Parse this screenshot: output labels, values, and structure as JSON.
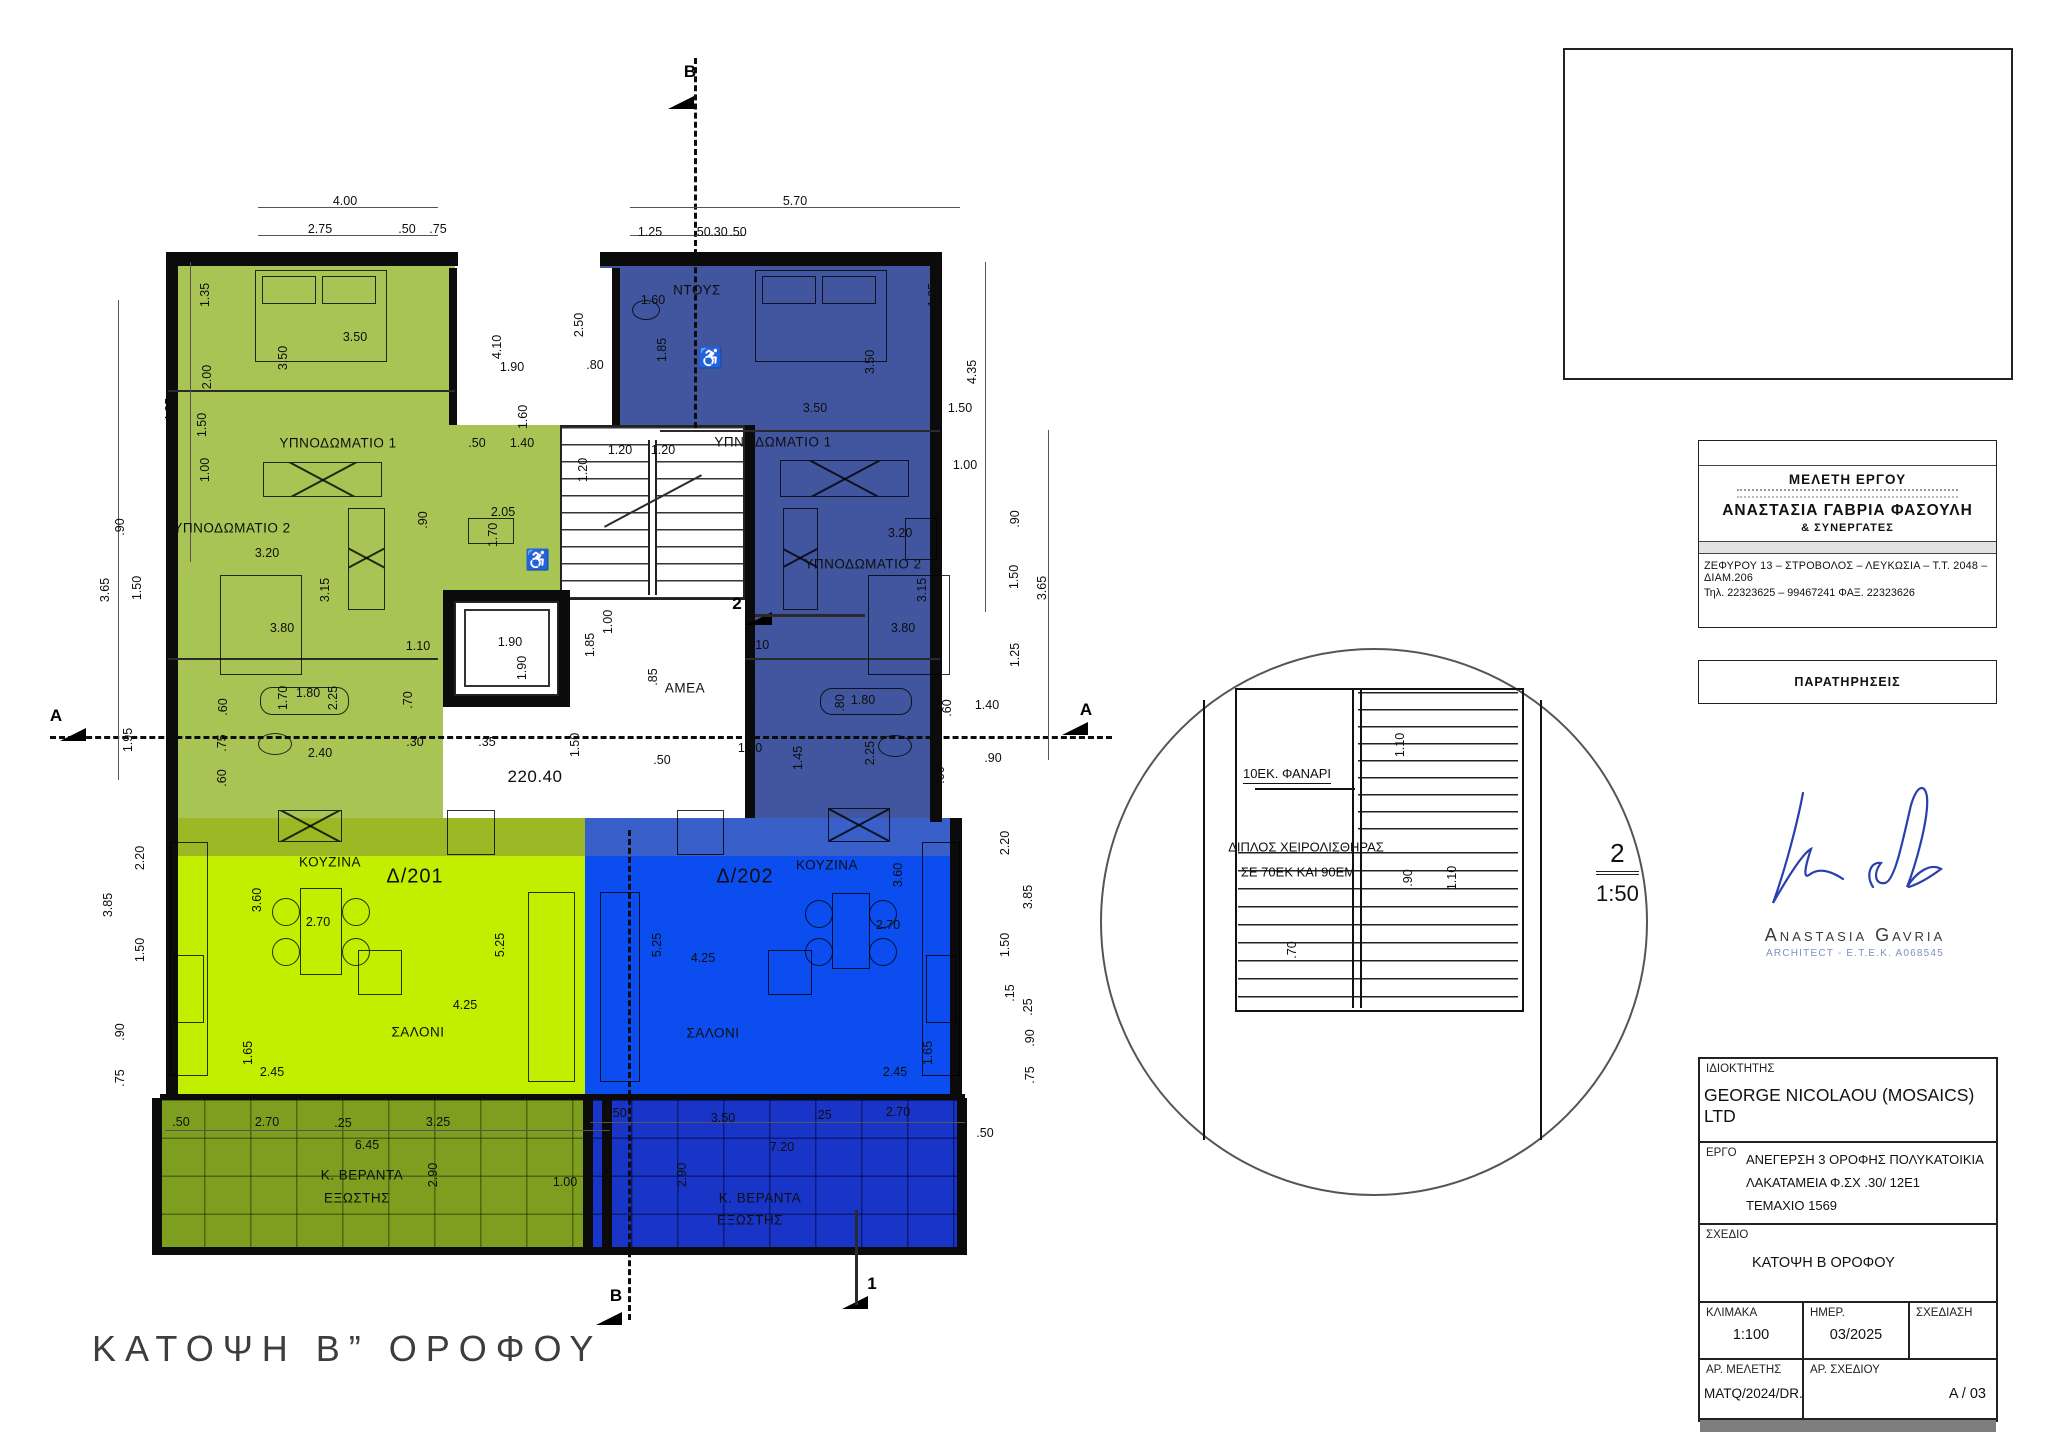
{
  "drawing_title": "ΚΑΤΟΨΗ Β” ΟΡΟΦΟΥ",
  "colors": {
    "green_bed": "#a8c455",
    "green_living": "#c2ee00",
    "green_veranda": "#7d9e1f",
    "blue_bed": "#41569f",
    "blue_living": "#0c4df0",
    "blue_veranda": "#1935c8",
    "signature_ink": "#2a3fae"
  },
  "plan": {
    "rooms": [
      {
        "t": "ΥΠΝΟΔΩΜΑΤΙΟ 1",
        "x": 338,
        "y": 443
      },
      {
        "t": "ΥΠΝΟΔΩΜΑΤΙΟ 2",
        "x": 232,
        "y": 528
      },
      {
        "t": "ΚΟΥΖΙΝΑ",
        "x": 330,
        "y": 862
      },
      {
        "t": "Δ/201",
        "x": 415,
        "y": 877,
        "c": "unit"
      },
      {
        "t": "ΣΑΛΟΝΙ",
        "x": 418,
        "y": 1032
      },
      {
        "t": "Κ. ΒΕΡΑΝΤΑ",
        "x": 362,
        "y": 1175
      },
      {
        "t": "ΕΞΩΣΤΗΣ",
        "x": 357,
        "y": 1198
      },
      {
        "t": "ΝΤΟΥΣ",
        "x": 697,
        "y": 290
      },
      {
        "t": "ΥΠΝΟΔΩΜΑΤΙΟ 1",
        "x": 773,
        "y": 442
      },
      {
        "t": "ΥΠΝΟΔΩΜΑΤΙΟ 2",
        "x": 863,
        "y": 564
      },
      {
        "t": "ΚΟΥΖΙΝΑ",
        "x": 827,
        "y": 865
      },
      {
        "t": "Δ/202",
        "x": 745,
        "y": 877,
        "c": "unit"
      },
      {
        "t": "ΣΑΛΟΝΙ",
        "x": 713,
        "y": 1033
      },
      {
        "t": "Κ. ΒΕΡΑΝΤΑ",
        "x": 760,
        "y": 1198
      },
      {
        "t": "ΕΞΩΣΤΗΣ",
        "x": 750,
        "y": 1220
      },
      {
        "t": "ΑΜΕΑ",
        "x": 685,
        "y": 688
      },
      {
        "t": "220.40",
        "x": 535,
        "y": 777,
        "c": "level"
      },
      {
        "t": "♿",
        "x": 538,
        "y": 560,
        "c": "unit"
      },
      {
        "t": "♿",
        "x": 711,
        "y": 358,
        "c": "unit"
      }
    ],
    "dims": [
      {
        "t": "4.00",
        "x": 345,
        "y": 201
      },
      {
        "t": "2.75",
        "x": 320,
        "y": 229
      },
      {
        "t": ".50",
        "x": 407,
        "y": 229
      },
      {
        "t": ".75",
        "x": 438,
        "y": 229
      },
      {
        "t": "5.70",
        "x": 795,
        "y": 201
      },
      {
        "t": "1.25",
        "x": 650,
        "y": 232
      },
      {
        "t": ".50",
        "x": 702,
        "y": 232
      },
      {
        "t": ".30",
        "x": 719,
        "y": 232
      },
      {
        "t": ".50",
        "x": 738,
        "y": 232
      },
      {
        "t": "1.35",
        "x": 205,
        "y": 295,
        "r": 1
      },
      {
        "t": "2.00",
        "x": 207,
        "y": 377,
        "r": 1
      },
      {
        "t": "1.50",
        "x": 202,
        "y": 425,
        "r": 1
      },
      {
        "t": "1.00",
        "x": 205,
        "y": 470,
        "r": 1
      },
      {
        "t": "4.35",
        "x": 170,
        "y": 410,
        "r": 1
      },
      {
        "t": ".90",
        "x": 120,
        "y": 527,
        "r": 1
      },
      {
        "t": "3.65",
        "x": 105,
        "y": 590,
        "r": 1
      },
      {
        "t": "1.50",
        "x": 137,
        "y": 588,
        "r": 1
      },
      {
        "t": "1.95",
        "x": 128,
        "y": 740,
        "r": 1
      },
      {
        "t": "2.20",
        "x": 140,
        "y": 858,
        "r": 1
      },
      {
        "t": "3.85",
        "x": 108,
        "y": 905,
        "r": 1
      },
      {
        "t": "1.50",
        "x": 140,
        "y": 950,
        "r": 1
      },
      {
        "t": ".90",
        "x": 120,
        "y": 1032,
        "r": 1
      },
      {
        "t": ".75",
        "x": 120,
        "y": 1078,
        "r": 1
      },
      {
        "t": "3.50",
        "x": 355,
        "y": 337
      },
      {
        "t": "3.50",
        "x": 283,
        "y": 358,
        "r": 1
      },
      {
        "t": "4.10",
        "x": 497,
        "y": 347,
        "r": 1
      },
      {
        "t": "1.90",
        "x": 512,
        "y": 367
      },
      {
        "t": "1.60",
        "x": 523,
        "y": 417,
        "r": 1
      },
      {
        "t": ".50",
        "x": 477,
        "y": 443
      },
      {
        "t": "1.40",
        "x": 522,
        "y": 443
      },
      {
        "t": "3.20",
        "x": 267,
        "y": 553
      },
      {
        "t": "3.15",
        "x": 325,
        "y": 590,
        "r": 1
      },
      {
        "t": "3.80",
        "x": 282,
        "y": 628
      },
      {
        "t": "1.10",
        "x": 418,
        "y": 646
      },
      {
        "t": "2.05",
        "x": 503,
        "y": 512
      },
      {
        "t": "1.70",
        "x": 493,
        "y": 535,
        "r": 1
      },
      {
        "t": ".90",
        "x": 423,
        "y": 520,
        "r": 1
      },
      {
        "t": "1.80",
        "x": 308,
        "y": 693
      },
      {
        "t": "2.25",
        "x": 333,
        "y": 698,
        "r": 1
      },
      {
        "t": "1.70",
        "x": 283,
        "y": 698,
        "r": 1
      },
      {
        "t": ".70",
        "x": 408,
        "y": 700,
        "r": 1
      },
      {
        "t": "2.40",
        "x": 320,
        "y": 753
      },
      {
        "t": ".30",
        "x": 415,
        "y": 742
      },
      {
        "t": ".60",
        "x": 223,
        "y": 707,
        "r": 1
      },
      {
        "t": ".75",
        "x": 222,
        "y": 743,
        "r": 1
      },
      {
        "t": ".60",
        "x": 222,
        "y": 778,
        "r": 1
      },
      {
        "t": ".90",
        "x": 173,
        "y": 703,
        "r": 1
      },
      {
        "t": "1.20",
        "x": 583,
        "y": 470,
        "r": 1
      },
      {
        "t": "1.20",
        "x": 620,
        "y": 450
      },
      {
        "t": "1.20",
        "x": 663,
        "y": 450
      },
      {
        "t": "1.00",
        "x": 608,
        "y": 622,
        "r": 1
      },
      {
        "t": "1.85",
        "x": 590,
        "y": 645,
        "r": 1
      },
      {
        "t": ".85",
        "x": 653,
        "y": 677,
        "r": 1
      },
      {
        "t": "1.90",
        "x": 510,
        "y": 642
      },
      {
        "t": "1.90",
        "x": 522,
        "y": 668,
        "r": 1
      },
      {
        "t": ".35",
        "x": 487,
        "y": 742
      },
      {
        "t": "1.50",
        "x": 575,
        "y": 745,
        "r": 1
      },
      {
        "t": ".50",
        "x": 662,
        "y": 760
      },
      {
        "t": ".70",
        "x": 750,
        "y": 697,
        "r": 1
      },
      {
        "t": "1.10",
        "x": 750,
        "y": 748
      },
      {
        "t": "1.60",
        "x": 653,
        "y": 300
      },
      {
        "t": "2.50",
        "x": 579,
        "y": 325,
        "r": 1
      },
      {
        "t": ".80",
        "x": 595,
        "y": 365
      },
      {
        "t": "1.85",
        "x": 662,
        "y": 350,
        "r": 1
      },
      {
        "t": "3.50",
        "x": 815,
        "y": 408
      },
      {
        "t": "3.50",
        "x": 870,
        "y": 362,
        "r": 1
      },
      {
        "t": "1.35",
        "x": 933,
        "y": 295,
        "r": 1
      },
      {
        "t": "2.00",
        "x": 935,
        "y": 390,
        "r": 1
      },
      {
        "t": "1.50",
        "x": 960,
        "y": 408
      },
      {
        "t": "1.00",
        "x": 965,
        "y": 465
      },
      {
        "t": "4.35",
        "x": 972,
        "y": 372,
        "r": 1
      },
      {
        "t": "3.20",
        "x": 900,
        "y": 533
      },
      {
        "t": "3.15",
        "x": 922,
        "y": 590,
        "r": 1
      },
      {
        "t": "3.80",
        "x": 903,
        "y": 628
      },
      {
        "t": "1.10",
        "x": 757,
        "y": 645
      },
      {
        "t": ".90",
        "x": 1015,
        "y": 519,
        "r": 1
      },
      {
        "t": "1.50",
        "x": 1014,
        "y": 577,
        "r": 1
      },
      {
        "t": "3.65",
        "x": 1042,
        "y": 588,
        "r": 1
      },
      {
        "t": "1.25",
        "x": 1015,
        "y": 655,
        "r": 1
      },
      {
        "t": "1.80",
        "x": 863,
        "y": 700
      },
      {
        "t": ".80",
        "x": 840,
        "y": 703,
        "r": 1
      },
      {
        "t": "2.25",
        "x": 870,
        "y": 753,
        "r": 1
      },
      {
        "t": "1.45",
        "x": 798,
        "y": 758,
        "r": 1
      },
      {
        "t": ".60",
        "x": 947,
        "y": 708,
        "r": 1
      },
      {
        "t": "1.40",
        "x": 987,
        "y": 705
      },
      {
        "t": ".75",
        "x": 938,
        "y": 743,
        "r": 1
      },
      {
        "t": ".90",
        "x": 993,
        "y": 758
      },
      {
        "t": ".60",
        "x": 940,
        "y": 775,
        "r": 1
      },
      {
        "t": "3.60",
        "x": 257,
        "y": 900,
        "r": 1
      },
      {
        "t": "2.70",
        "x": 318,
        "y": 922
      },
      {
        "t": "5.25",
        "x": 500,
        "y": 945,
        "r": 1
      },
      {
        "t": "4.25",
        "x": 465,
        "y": 1005
      },
      {
        "t": "1.65",
        "x": 248,
        "y": 1053,
        "r": 1
      },
      {
        "t": "2.45",
        "x": 272,
        "y": 1072
      },
      {
        "t": "3.60",
        "x": 898,
        "y": 875,
        "r": 1
      },
      {
        "t": "2.70",
        "x": 888,
        "y": 925
      },
      {
        "t": "5.25",
        "x": 657,
        "y": 945,
        "r": 1
      },
      {
        "t": "4.25",
        "x": 703,
        "y": 958
      },
      {
        "t": "1.65",
        "x": 928,
        "y": 1053,
        "r": 1
      },
      {
        "t": "2.45",
        "x": 895,
        "y": 1072
      },
      {
        "t": "2.20",
        "x": 1005,
        "y": 843,
        "r": 1
      },
      {
        "t": "3.85",
        "x": 1028,
        "y": 897,
        "r": 1
      },
      {
        "t": "1.50",
        "x": 1005,
        "y": 945,
        "r": 1
      },
      {
        "t": ".90",
        "x": 1030,
        "y": 1038,
        "r": 1
      },
      {
        "t": ".75",
        "x": 1030,
        "y": 1075,
        "r": 1
      },
      {
        "t": ".15",
        "x": 1010,
        "y": 993,
        "r": 1
      },
      {
        "t": ".25",
        "x": 1028,
        "y": 1007,
        "r": 1
      },
      {
        "t": ".50",
        "x": 181,
        "y": 1122
      },
      {
        "t": "2.70",
        "x": 267,
        "y": 1122
      },
      {
        "t": ".25",
        "x": 343,
        "y": 1123
      },
      {
        "t": "3.25",
        "x": 438,
        "y": 1122
      },
      {
        "t": "6.45",
        "x": 367,
        "y": 1145
      },
      {
        "t": "2.90",
        "x": 433,
        "y": 1175,
        "r": 1
      },
      {
        "t": "1.00",
        "x": 565,
        "y": 1182
      },
      {
        "t": ".50",
        "x": 618,
        "y": 1113
      },
      {
        "t": "3.50",
        "x": 723,
        "y": 1118
      },
      {
        "t": ".25",
        "x": 823,
        "y": 1115
      },
      {
        "t": "2.70",
        "x": 898,
        "y": 1112
      },
      {
        "t": ".50",
        "x": 985,
        "y": 1133
      },
      {
        "t": "7.20",
        "x": 782,
        "y": 1147
      },
      {
        "t": "2.90",
        "x": 682,
        "y": 1175,
        "r": 1
      }
    ],
    "markers": [
      {
        "t": "B",
        "x": 690,
        "y": 72
      },
      {
        "t": "B",
        "x": 616,
        "y": 1296
      },
      {
        "t": "A",
        "x": 56,
        "y": 716
      },
      {
        "t": "A",
        "x": 1086,
        "y": 710
      },
      {
        "t": "1",
        "x": 872,
        "y": 1284
      },
      {
        "t": "2",
        "x": 737,
        "y": 604
      }
    ]
  },
  "detail": {
    "callout_number": "2",
    "scale": "1:50",
    "note_lantern": "10ΕΚ. ΦΑΝΑΡΙ",
    "note_handrail_1": "ΔΙΠΛΟΣ ΧΕΙΡΟΛΙΣΘΗΡΑΣ",
    "note_handrail_2": "ΣΕ 70ΕΚ ΚΑΙ 90ΕΜ",
    "dims": [
      {
        "t": "1.10",
        "x": 1400,
        "y": 745,
        "r": 1
      },
      {
        "t": ".90",
        "x": 1408,
        "y": 878,
        "r": 1
      },
      {
        "t": "1.10",
        "x": 1452,
        "y": 878,
        "r": 1
      },
      {
        "t": ".70",
        "x": 1292,
        "y": 950,
        "r": 1
      }
    ]
  },
  "architect_block": {
    "header": "ΜΕΛΕΤΗ ΕΡΓΟΥ",
    "name": "ΑΝΑΣΤΑΣΙΑ ΓΑΒΡΙΑ ΦΑΣΟΥΛΗ",
    "partners": "& ΣΥΝΕΡΓΑΤΕΣ",
    "address": "ΖΕΦΥΡΟΥ 13 – ΣΤΡΟΒΟΛΟΣ – ΛΕΥΚΩΣΙΑ – Τ.Τ. 2048 – ΔΙΑΜ.206",
    "phone": "Τηλ. 22323625 – 99467241   ΦΑΞ. 22323626"
  },
  "notes_block": {
    "header": "ΠΑΡΑΤΗΡΗΣΕΙΣ"
  },
  "signature": {
    "name": "Anastasia Gavria",
    "subtitle": "ARCHITECT - E.T.E.K. A068545"
  },
  "title_block": {
    "owner_label": "ΙΔΙΟΚΤΗΤΗΣ",
    "owner": "GEORGE NICOLAOU (MOSAICS) LTD",
    "project_label": "ΕΡΓΟ",
    "project_lines": [
      "ΑΝΕΓΕΡΣΗ 3 ΟΡΟΦΗΣ ΠΟΛΥΚΑΤΟΙΚΙΑ",
      "ΛΑΚΑΤΑΜΕΙΑ Φ.ΣΧ .30/ 12Ε1",
      "ΤΕΜΑΧΙΟ 1569"
    ],
    "drawing_label": "ΣΧΕΔΙΟ",
    "drawing": "ΚΑΤΟΨΗ Β ΟΡΟΦΟΥ",
    "scale_label": "ΚΛΙΜΑΚΑ",
    "scale": "1:100",
    "date_label": "ΗΜΕΡ.",
    "date": "03/2025",
    "drafting_label": "ΣΧΕΔΙΑΣΗ",
    "drafting": "",
    "study_no_label": "ΑΡ. ΜΕΛΕΤΗΣ",
    "study_no": "MATQ/2024/DR.",
    "sheet_no_label": "ΑΡ. ΣΧΕΔΙΟΥ",
    "sheet_no": "A / 03"
  }
}
